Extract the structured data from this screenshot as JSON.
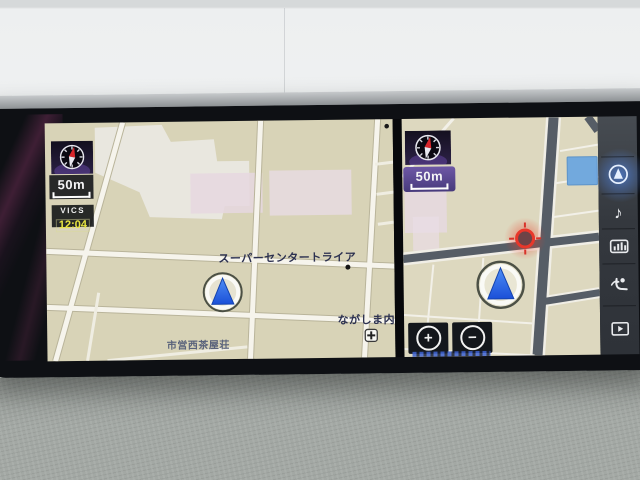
{
  "left_map": {
    "scale": "50m",
    "vics_label": "VICS",
    "vics_time": "12:04",
    "labels": {
      "store": "スーパーセンタートライア",
      "clinic": "ながしま内科",
      "housing": "市営西茶屋荘"
    }
  },
  "right_map": {
    "scale": "50m",
    "zoom_in_label": "+",
    "zoom_out_label": "−"
  },
  "sidebar": {
    "music_note_glyph": "♪",
    "items": [
      {
        "name": "navigation-map",
        "active": true
      },
      {
        "name": "audio",
        "active": false
      },
      {
        "name": "audio-levels",
        "active": false
      },
      {
        "name": "seat-climate",
        "active": false
      },
      {
        "name": "video",
        "active": false
      }
    ]
  },
  "colors": {
    "map_bg": "#d8d3b7",
    "road_light": "#f6f4ec",
    "road_dark": "#565d66",
    "building_gray": "#e9e7df",
    "building_pink": "#e6d7e0",
    "building_blue": "#72a9dd",
    "scale_purple": "#5c4a90",
    "vics_yellow": "#e8e540",
    "active_blue": "#4d8df0",
    "marker_red": "#e5322a"
  }
}
